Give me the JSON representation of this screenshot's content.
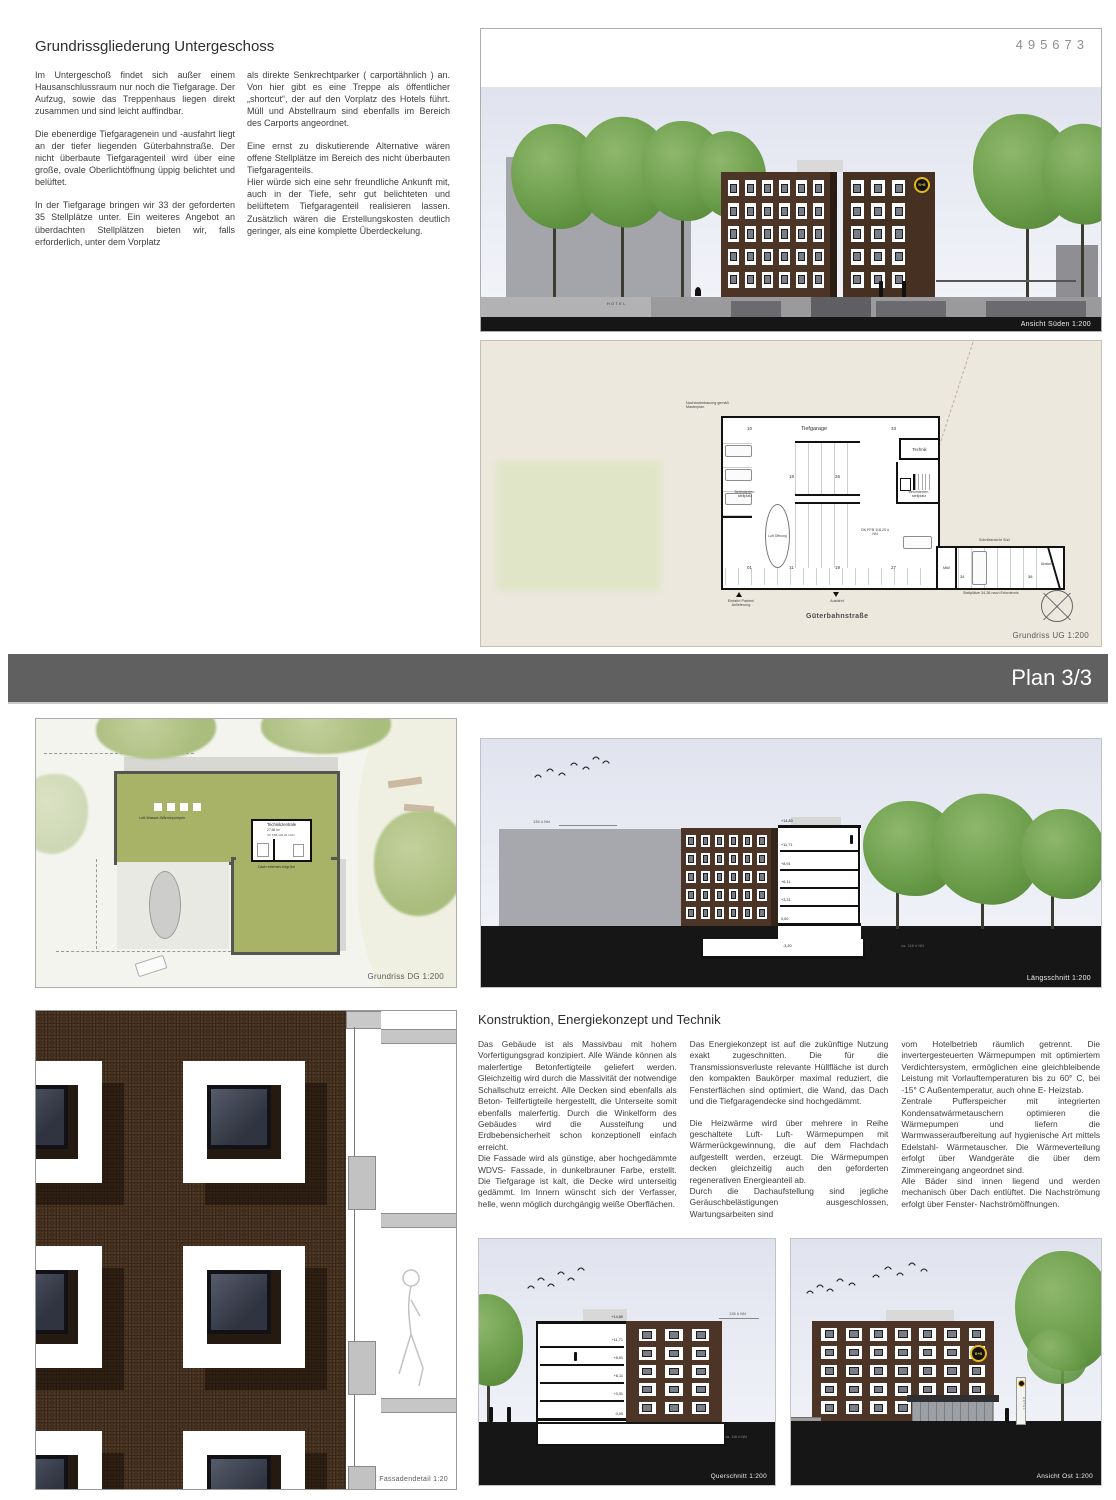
{
  "sheet": {
    "number": "495673",
    "banner": "Plan 3/3"
  },
  "intro": {
    "title": "Grundrissgliederung Untergeschoss",
    "col1": [
      "Im Untergeschoß findet sich außer einem Hausanschlussraum nur noch die Tiefgarage. Der Aufzug, sowie das Treppenhaus liegen direkt zusammen und sind leicht auffindbar.",
      "Die ebenerdige Tiefgaragenein und -ausfahrt liegt an der tiefer liegenden Güterbahnstraße. Der nicht überbaute Tiefgaragenteil wird über eine große, ovale Oberlichtöffnung üppig belichtet und belüftet.",
      "In der Tiefgarage bringen wir 33 der geforderten 35 Stellplätze unter. Ein weiteres Angebot an überdachten Stellplätzen bieten wir, falls erforderlich, unter dem Vorplatz"
    ],
    "col2": [
      "als direkte Senkrechtparker ( carportähnlich ) an. Von hier gibt es eine Treppe als öffentlicher „shortcut“, der auf den Vorplatz des Hotels führt. Müll und Abstellraum sind ebenfalls im Bereich des Carports angeordnet.",
      "Eine ernst zu diskutierende Alternative wären offene Stellplätze im Bereich des nicht überbauten Tiefgaragenteils.",
      "Hier würde sich eine sehr freundliche Ankunft mit, auch in der Tiefe, sehr gut belichteten und belüftetem Tiefgaragenteil realisieren lassen. Zusätzlich wären die Erstellungskosten deutlich geringer, als eine komplette Überdeckelung."
    ]
  },
  "ansicht_sued": {
    "label": "Ansicht Süden 1:200",
    "hotel_sign": "HOTEL",
    "logo": "B+B"
  },
  "grundriss_ug": {
    "label": "Grundriss UG 1:200",
    "title": "Tiefgarage",
    "street": "Güterbahnstraße",
    "neighbor_note": "Nachbarbebauung gemäß Masterplan",
    "technik": "Technik",
    "muell": "Müll",
    "abstell": "Abstell",
    "luft": "Luft Öffnung",
    "ok_ffb": "OK FFB 118,20 ü NN",
    "behinderten": "Behinderten- stellplatz",
    "schnittansicht": "Schnittansicht Süd",
    "stellplaetze_note": "Stellplätze 34-38 nach Erfordernis",
    "einfahrt": "Einfahrt Parken/ Anlieferung",
    "ausfahrt": "Ausfahrt",
    "stall_numbers": [
      "10",
      "33",
      "18",
      "26",
      "01",
      "11",
      "19",
      "27",
      "34",
      "38"
    ]
  },
  "grundriss_dg": {
    "label": "Grundriss DG 1:200",
    "technikzentrale": "Technikzentrale",
    "technik_area": "27,66 m²",
    "technik_level": "OK FFB 136,20 ü NN",
    "waermepumpen": "Luft-Wasser-Wärmepumpen",
    "dach": "Dach extensiv begrünt"
  },
  "laengsschnitt": {
    "label": "Längsschnitt 1:200",
    "nn_top": "135 ü NN",
    "nn_bottom": "ca. 116 ü NN",
    "levels": [
      "+14,80",
      "+11,71",
      "+8,91",
      "+6,11",
      "+3,31",
      "0,00",
      "-3,20"
    ]
  },
  "konstruktion": {
    "title": "Konstruktion, Energiekonzept und Technik",
    "col1": [
      "Das Gebäude ist als Massivbau mit hohem Vorfertigungsgrad konzipiert. Alle Wände können als malerfertige Betonfertigteile geliefert werden. Gleichzeitig wird durch die Massivität der notwendige Schallschutz erreicht. Alle Decken sind ebenfalls als Beton- Teilfertigteile hergestellt, die Unterseite somit ebenfalls malerfertig. Durch die Winkelform des Gebäudes wird die Aussteifung und Erdbebensicherheit schon konzeptionell einfach erreicht.",
      "Die Fassade wird als günstige, aber hochgedämmte WDVS- Fassade, in dunkelbrauner Farbe, erstellt. Die Tiefgarage ist kalt, die Decke wird unterseitig gedämmt. Im Innern wünscht sich der Verfasser, helle, wenn möglich durchgängig weiße Oberflächen."
    ],
    "col2": [
      "Das Energiekonzept ist auf die zukünftige Nutzung exakt zugeschnitten. Die für die Transmissionsverluste relevante Hüllfläche ist durch den kompakten Baukörper maximal reduziert, die Fensterflächen sind optimiert, die Wand, das Dach und die Tiefgaragendecke sind hochgedämmt.",
      "Die Heizwärme wird über mehrere in Reihe geschaltete Luft- Luft- Wärmepumpen mit Wärmerückgewinnung, die auf dem Flachdach aufgestellt werden, erzeugt. Die Wärmepumpen decken gleichzeitig auch den geforderten regenerativen Energieanteil ab.",
      "Durch die Dachaufstellung sind jegliche Geräuschbelästigungen ausgeschlossen, Wartungsarbeiten sind"
    ],
    "col3": [
      "vom Hotelbetrieb räumlich getrennt. Die invertergesteuerten Wärmepumpen mit optimiertem Verdichtersystem, ermöglichen eine gleichbleibende Leistung mit Vorlauftemperaturen bis zu 60° C, bei -15° C Außentemperatur, auch ohne E- Heizstab.",
      "Zentrale Pufferspeicher mit integrierten Kondensatwärmetauschern optimieren die Wärmepumpen und liefern die Warmwasseraufbereitung auf hygienische Art mittels Edelstahl- Wärmetauscher. Die Wärmeverteilung erfolgt über Wandgeräte die über dem Zimmereingang angeordnet sind.",
      "Alle Bäder sind innen liegend und werden mechanisch über Dach entlüftet. Die Nachströmung erfolgt über Fenster- Nachströmöffnungen."
    ]
  },
  "fassadendetail": {
    "label": "Fassadendetail 1:20"
  },
  "querschnitt": {
    "label": "Querschnitt 1:200",
    "nn_top": "135 ü NN",
    "nn_bottom": "ca. 116 ü NN",
    "levels": [
      "+14,80",
      "+11,71",
      "+8,91",
      "+6,11",
      "+3,31",
      "0,00",
      "-3,20"
    ]
  },
  "ansicht_ost": {
    "label": "Ansicht Ost 1:200",
    "logo": "B+B",
    "pylon": "HOTEL"
  },
  "colors": {
    "facade_brown": "#4c3526",
    "roof_green": "#a9b368",
    "banner_gray": "#606060",
    "logo_yellow": "#e6b91f",
    "ground_black": "#161616"
  }
}
